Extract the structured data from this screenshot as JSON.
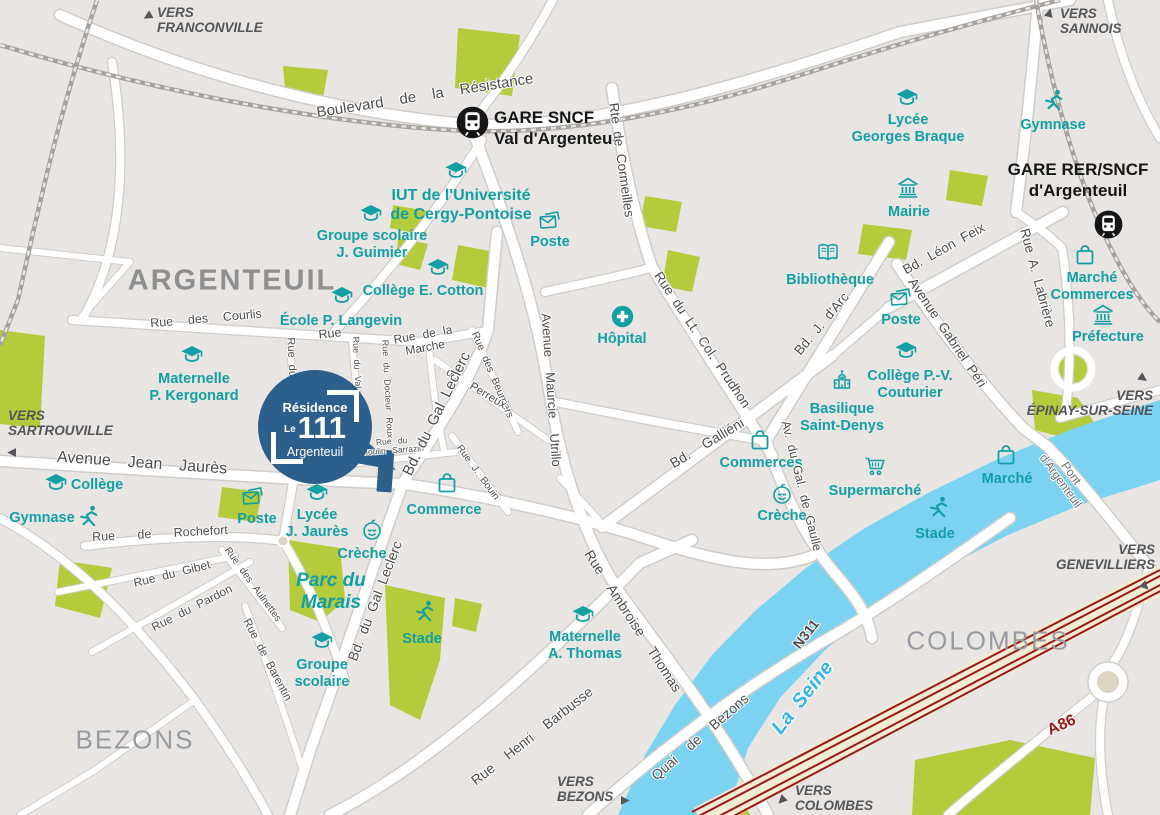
{
  "canvas": {
    "width": 1160,
    "height": 815
  },
  "colors": {
    "background": "#e8e5e2",
    "road": "#ffffff",
    "road_casing": "#d0cdc9",
    "green": "#b4cb3b",
    "river": "#7cd3f1",
    "poi_teal": "#13a0a5",
    "street_label": "#4d4d4d",
    "area_label": "#979ca3",
    "vers_label": "#55565a",
    "marker_blue": "#2d5f8d",
    "rail": "#a6a39f",
    "a86_fill": "#f2ecd4",
    "a86_line": "#9e1717",
    "seine_label": "#35b5e8"
  },
  "marker": {
    "line1": "Résidence",
    "line2_prefix": "Le",
    "line2_number": "111",
    "line3": "Argenteuil",
    "x": 315,
    "y": 427,
    "radius": 57
  },
  "areas": [
    {
      "name": "area-argenteuil",
      "label": "ARGENTEUIL",
      "x": 232,
      "y": 281,
      "size": 29,
      "bold": true,
      "color": "#8f8f8f"
    },
    {
      "name": "area-bezons",
      "label": "BEZONS",
      "x": 135,
      "y": 740,
      "size": 26,
      "bold": false,
      "color": "#979ca3"
    },
    {
      "name": "area-colombes",
      "label": "COLOMBES",
      "x": 988,
      "y": 641,
      "size": 26,
      "bold": false,
      "color": "#979ca3"
    }
  ],
  "directions": [
    {
      "name": "vers-franconville",
      "lines": [
        "VERS",
        "FRANCONVILLE"
      ],
      "x": 157,
      "y": 5,
      "align": "left",
      "arrow": {
        "x": 140,
        "y": 8,
        "rotate": -120
      }
    },
    {
      "name": "vers-sannois",
      "lines": [
        "VERS",
        "SANNOIS"
      ],
      "x": 1060,
      "y": 6,
      "align": "left",
      "arrow": {
        "x": 1042,
        "y": 4,
        "rotate": 15
      }
    },
    {
      "name": "vers-sartrouville",
      "lines": [
        "VERS",
        "SARTROUVILLE"
      ],
      "x": 8,
      "y": 408,
      "align": "left",
      "arrow": {
        "x": 4,
        "y": 444,
        "rotate": -90
      }
    },
    {
      "name": "vers-epinay-sur-seine",
      "lines": [
        "VERS",
        "ÉPINAY-SUR-SEINE"
      ],
      "x": 1153,
      "y": 388,
      "align": "right",
      "arrow": {
        "x": 1136,
        "y": 370,
        "rotate": 125
      }
    },
    {
      "name": "vers-genevilliers",
      "lines": [
        "VERS",
        "GENEVILLIERS"
      ],
      "x": 1155,
      "y": 542,
      "align": "right",
      "arrow": {
        "x": 1138,
        "y": 578,
        "rotate": 135
      }
    },
    {
      "name": "vers-bezons",
      "lines": [
        "VERS",
        "BEZONS"
      ],
      "x": 557,
      "y": 774,
      "align": "left",
      "arrow": {
        "x": 618,
        "y": 792,
        "rotate": 90
      }
    },
    {
      "name": "vers-colombes",
      "lines": [
        "VERS",
        "COLOMBES"
      ],
      "x": 795,
      "y": 783,
      "align": "left",
      "arrow": {
        "x": 774,
        "y": 792,
        "rotate": -135
      }
    }
  ],
  "stations": [
    {
      "name": "gare-sncf-val-argenteuil",
      "lines": [
        "GARE SNCF",
        "Val d'Argenteuil"
      ],
      "x": 494,
      "y": 108,
      "align": "left",
      "icon": {
        "x": 472,
        "y": 122,
        "size": 33
      }
    },
    {
      "name": "gare-rer-sncf-argenteuil",
      "lines": [
        "GARE RER/SNCF",
        "d'Argenteuil"
      ],
      "x": 1078,
      "y": 160,
      "align": "center",
      "icon": {
        "x": 1108,
        "y": 224,
        "size": 29
      }
    }
  ],
  "pois": [
    {
      "name": "poi-lycee-georges-braque",
      "icon": "school",
      "lines": [
        "Lycée",
        "Georges Braque"
      ],
      "x": 908,
      "y": 112,
      "icon_x": 907,
      "icon_y": 98
    },
    {
      "name": "poi-gymnase-nord",
      "icon": "runner",
      "lines": [
        "Gymnase"
      ],
      "x": 1053,
      "y": 117,
      "icon_x": 1053,
      "icon_y": 101
    },
    {
      "name": "poi-mairie",
      "icon": "bank",
      "lines": [
        "Mairie"
      ],
      "x": 909,
      "y": 204,
      "icon_x": 908,
      "icon_y": 188
    },
    {
      "name": "poi-iut-cergy",
      "icon": "school",
      "lines": [
        "IUT de l'Université",
        "de Cergy-Pontoise"
      ],
      "x": 461,
      "y": 187,
      "icon_x": 456,
      "icon_y": 171,
      "size": 16
    },
    {
      "name": "poi-groupe-scolaire-guimier",
      "icon": "school",
      "lines": [
        "Groupe scolaire",
        "J. Guimier"
      ],
      "x": 372,
      "y": 228,
      "icon_x": 371,
      "icon_y": 214
    },
    {
      "name": "poi-poste-centre",
      "icon": "mail",
      "lines": [
        "Poste"
      ],
      "x": 550,
      "y": 234,
      "icon_x": 550,
      "icon_y": 220
    },
    {
      "name": "poi-college-cotton",
      "icon": "school",
      "lines": [
        "Collège E. Cotton"
      ],
      "x": 423,
      "y": 283,
      "icon_x": 438,
      "icon_y": 268
    },
    {
      "name": "poi-ecole-langevin",
      "icon": "school",
      "lines": [
        "École P. Langevin"
      ],
      "x": 341,
      "y": 313,
      "icon_x": 342,
      "icon_y": 296
    },
    {
      "name": "poi-bibliotheque",
      "icon": "book",
      "lines": [
        "Bibliothèque"
      ],
      "x": 830,
      "y": 272,
      "icon_x": 828,
      "icon_y": 253
    },
    {
      "name": "poi-poste-est",
      "icon": "mail",
      "lines": [
        "Poste"
      ],
      "x": 901,
      "y": 312,
      "icon_x": 901,
      "icon_y": 297
    },
    {
      "name": "poi-college-couturier",
      "icon": "school",
      "lines": [
        "Collège P.-V.",
        "Couturier"
      ],
      "x": 910,
      "y": 368,
      "icon_x": 906,
      "icon_y": 351
    },
    {
      "name": "poi-basilique-saint-denys",
      "icon": "church",
      "lines": [
        "Basilique",
        "Saint-Denys"
      ],
      "x": 842,
      "y": 401,
      "icon_x": 842,
      "icon_y": 379
    },
    {
      "name": "poi-hopital",
      "icon": "hospital",
      "lines": [
        "Hôpital"
      ],
      "x": 622,
      "y": 331,
      "icon_x": 622,
      "icon_y": 316
    },
    {
      "name": "poi-maternelle-kergonard",
      "icon": "school",
      "lines": [
        "Maternelle",
        "P. Kergonard"
      ],
      "x": 194,
      "y": 371,
      "icon_x": 192,
      "icon_y": 355
    },
    {
      "name": "poi-marche-commerces",
      "icon": "bag",
      "lines": [
        "Marché",
        "Commerces"
      ],
      "x": 1092,
      "y": 270,
      "icon_x": 1085,
      "icon_y": 255
    },
    {
      "name": "poi-prefecture",
      "icon": "bank",
      "lines": [
        "Préfecture"
      ],
      "x": 1108,
      "y": 329,
      "icon_x": 1103,
      "icon_y": 315
    },
    {
      "name": "poi-college-ouest",
      "icon": "school",
      "lines": [
        "Collège"
      ],
      "x": 97,
      "y": 477,
      "icon_x": 56,
      "icon_y": 483
    },
    {
      "name": "poi-gymnase-ouest",
      "icon": "runner",
      "lines": [
        "Gymnase"
      ],
      "x": 42,
      "y": 510,
      "icon_x": 88,
      "icon_y": 517
    },
    {
      "name": "poi-poste-ouest",
      "icon": "mail",
      "lines": [
        "Poste"
      ],
      "x": 257,
      "y": 511,
      "icon_x": 253,
      "icon_y": 496
    },
    {
      "name": "poi-lycee-jaures",
      "icon": "school",
      "lines": [
        "Lycée",
        "J. Jaurès"
      ],
      "x": 317,
      "y": 507,
      "icon_x": 317,
      "icon_y": 493
    },
    {
      "name": "poi-creche-ouest",
      "icon": "baby",
      "lines": [
        "Crèche"
      ],
      "x": 362,
      "y": 546,
      "icon_x": 372,
      "icon_y": 530
    },
    {
      "name": "poi-commerce",
      "icon": "bag",
      "lines": [
        "Commerce"
      ],
      "x": 444,
      "y": 502,
      "icon_x": 447,
      "icon_y": 483
    },
    {
      "name": "poi-parc-du-marais",
      "icon": null,
      "lines": [
        "Parc du",
        "Marais"
      ],
      "x": 331,
      "y": 570,
      "italic": true,
      "size": 19
    },
    {
      "name": "poi-stade-ouest",
      "icon": "runner",
      "lines": [
        "Stade"
      ],
      "x": 422,
      "y": 631,
      "icon_x": 424,
      "icon_y": 612
    },
    {
      "name": "poi-groupe-scolaire-sud",
      "icon": "school",
      "lines": [
        "Groupe",
        "scolaire"
      ],
      "x": 322,
      "y": 657,
      "icon_x": 322,
      "icon_y": 641
    },
    {
      "name": "poi-maternelle-thomas",
      "icon": "school",
      "lines": [
        "Maternelle",
        "A. Thomas"
      ],
      "x": 585,
      "y": 629,
      "icon_x": 583,
      "icon_y": 615
    },
    {
      "name": "poi-commerces-est",
      "icon": "bag",
      "lines": [
        "Commerces"
      ],
      "x": 761,
      "y": 455,
      "icon_x": 760,
      "icon_y": 440
    },
    {
      "name": "poi-creche-est",
      "icon": "baby",
      "lines": [
        "Crèche"
      ],
      "x": 782,
      "y": 508,
      "icon_x": 782,
      "icon_y": 494
    },
    {
      "name": "poi-supermarche",
      "icon": "cart",
      "lines": [
        "Supermarché"
      ],
      "x": 875,
      "y": 483,
      "icon_x": 875,
      "icon_y": 466
    },
    {
      "name": "poi-marche-est",
      "icon": "bag",
      "lines": [
        "Marché"
      ],
      "x": 1007,
      "y": 471,
      "icon_x": 1006,
      "icon_y": 455
    },
    {
      "name": "poi-stade-est",
      "icon": "runner",
      "lines": [
        "Stade"
      ],
      "x": 935,
      "y": 526,
      "icon_x": 938,
      "icon_y": 508
    }
  ],
  "streets": [
    {
      "name": "street-bd-resistance",
      "label": "Boulevard  de  la  Résistance",
      "x": 425,
      "y": 96,
      "rotate": -9,
      "size": 15
    },
    {
      "name": "street-rte-cormeilles",
      "label": "Rte de Cormeilles",
      "x": 621,
      "y": 160,
      "rotate": 82,
      "size": 13.5
    },
    {
      "name": "street-rue-lt-col-prudhon",
      "label": "Rue du Lt. Col. Prudhon",
      "x": 702,
      "y": 340,
      "rotate": 56,
      "size": 13.5
    },
    {
      "name": "street-bd-j-darc",
      "label": "Bd. J. d'Arc",
      "x": 822,
      "y": 324,
      "rotate": -50,
      "size": 13.5
    },
    {
      "name": "street-bd-leon-feix",
      "label": "Bd. Léon Feix",
      "x": 944,
      "y": 249,
      "rotate": -29,
      "size": 13.5
    },
    {
      "name": "street-av-gabriel-peri",
      "label": "Avenue Gabriel Péri",
      "x": 947,
      "y": 333,
      "rotate": 56,
      "size": 13.5
    },
    {
      "name": "street-rue-labriere",
      "label": "Rue A. Labrière",
      "x": 1037,
      "y": 278,
      "rotate": 75,
      "size": 13.5
    },
    {
      "name": "street-rue-de-la-marche",
      "label": "Rue de la\nMarche",
      "x": 424,
      "y": 341,
      "rotate": -10,
      "size": 12
    },
    {
      "name": "street-av-maurice-utrillo",
      "label": "Avenue  Maurcie  Utrillo",
      "x": 551,
      "y": 390,
      "rotate": 86,
      "size": 13
    },
    {
      "name": "street-rue-des-beurriers",
      "label": "Rue des Beurriers",
      "x": 492,
      "y": 375,
      "rotate": 67,
      "size": 10.5
    },
    {
      "name": "street-du-perreux",
      "label": "du  Perreux",
      "x": 476,
      "y": 389,
      "rotate": 31,
      "size": 11.5
    },
    {
      "name": "street-rue-des-courlis",
      "label": "Rue  des  Courlis",
      "x": 206,
      "y": 319,
      "rotate": -5,
      "size": 12.5
    },
    {
      "name": "street-rue",
      "label": "Rue",
      "x": 330,
      "y": 334,
      "rotate": -6,
      "size": 12.5
    },
    {
      "name": "street-rue-du-troupeau",
      "label": "Rue du Troupeau",
      "x": 292,
      "y": 384,
      "rotate": 87,
      "size": 11
    },
    {
      "name": "street-rue-val-notre-dame",
      "label": "Rue du Val Notre Dame",
      "x": 358,
      "y": 392,
      "rotate": 87,
      "size": 9
    },
    {
      "name": "street-rue-docteur-roux",
      "label": "Rue du Docteur Roux",
      "x": 387,
      "y": 389,
      "rotate": 87,
      "size": 9
    },
    {
      "name": "street-moulin-sarrazin",
      "label": "Rue du\nMoulin Sarrazin",
      "x": 392,
      "y": 446,
      "rotate": -4,
      "size": 8.5
    },
    {
      "name": "street-bd-gal-leclerc-nord",
      "label": "Bd. du Gal Leclerc",
      "x": 437,
      "y": 414,
      "rotate": -64,
      "size": 15
    },
    {
      "name": "street-rue-j-bouin",
      "label": "Rue J. Bouin",
      "x": 477,
      "y": 473,
      "rotate": 54,
      "size": 10
    },
    {
      "name": "street-av-jean-jaures",
      "label": "Avenue  Jean  Jaurès",
      "x": 142,
      "y": 464,
      "rotate": 4,
      "size": 16
    },
    {
      "name": "street-rue-de-rochefort",
      "label": "Rue   de   Rochefort",
      "x": 160,
      "y": 534,
      "rotate": -3,
      "size": 12.5
    },
    {
      "name": "street-rue-du-gibet",
      "label": "Rue du Gibet",
      "x": 172,
      "y": 574,
      "rotate": -14,
      "size": 12
    },
    {
      "name": "street-rue-du-pardon",
      "label": "Rue du Pardon",
      "x": 192,
      "y": 608,
      "rotate": -27,
      "size": 12
    },
    {
      "name": "street-rue-des-aulnettes",
      "label": "Rue des Aulnettes",
      "x": 252,
      "y": 585,
      "rotate": 54,
      "size": 10
    },
    {
      "name": "street-rue-de-barentin",
      "label": "Rue de Barentin",
      "x": 267,
      "y": 660,
      "rotate": 62,
      "size": 11.5
    },
    {
      "name": "street-bd-gal-leclerc-sud",
      "label": "Bd. du Gal Leclerc",
      "x": 375,
      "y": 601,
      "rotate": -69,
      "size": 14
    },
    {
      "name": "street-rue-ambroise-thomas",
      "label": "Rue  Ambroise  Thomas",
      "x": 633,
      "y": 621,
      "rotate": 57,
      "size": 14
    },
    {
      "name": "street-rue-henri-barbusse",
      "label": "Rue  Henri  Barbusse",
      "x": 532,
      "y": 736,
      "rotate": -38,
      "size": 14
    },
    {
      "name": "street-quai-de-bezons",
      "label": "Quai  de  Bezons",
      "x": 700,
      "y": 737,
      "rotate": -41,
      "size": 14
    },
    {
      "name": "street-bd-gallieni",
      "label": "Bd.  Galliéni",
      "x": 707,
      "y": 443,
      "rotate": -31,
      "size": 14
    },
    {
      "name": "street-av-gal-de-gaulle",
      "label": "Av. du Gal. de Gaulle",
      "x": 801,
      "y": 486,
      "rotate": 76,
      "size": 12.5
    },
    {
      "name": "street-n311",
      "label": "N311",
      "x": 806,
      "y": 634,
      "rotate": -52,
      "size": 14,
      "bold": true
    },
    {
      "name": "street-pont-argenteuil",
      "label": "Pont\nd'Argenteuil",
      "x": 1066,
      "y": 477,
      "rotate": 54,
      "size": 12,
      "color": "#6d6d6d"
    },
    {
      "name": "label-la-seine",
      "label": "La Seine",
      "x": 803,
      "y": 698,
      "rotate": -52,
      "size": 20,
      "color": "#35b5e8",
      "italic": true,
      "bold": true
    },
    {
      "name": "label-a86",
      "label": "A86",
      "x": 1062,
      "y": 726,
      "rotate": -24,
      "size": 16,
      "color": "#9e1717",
      "bold": true
    }
  ]
}
